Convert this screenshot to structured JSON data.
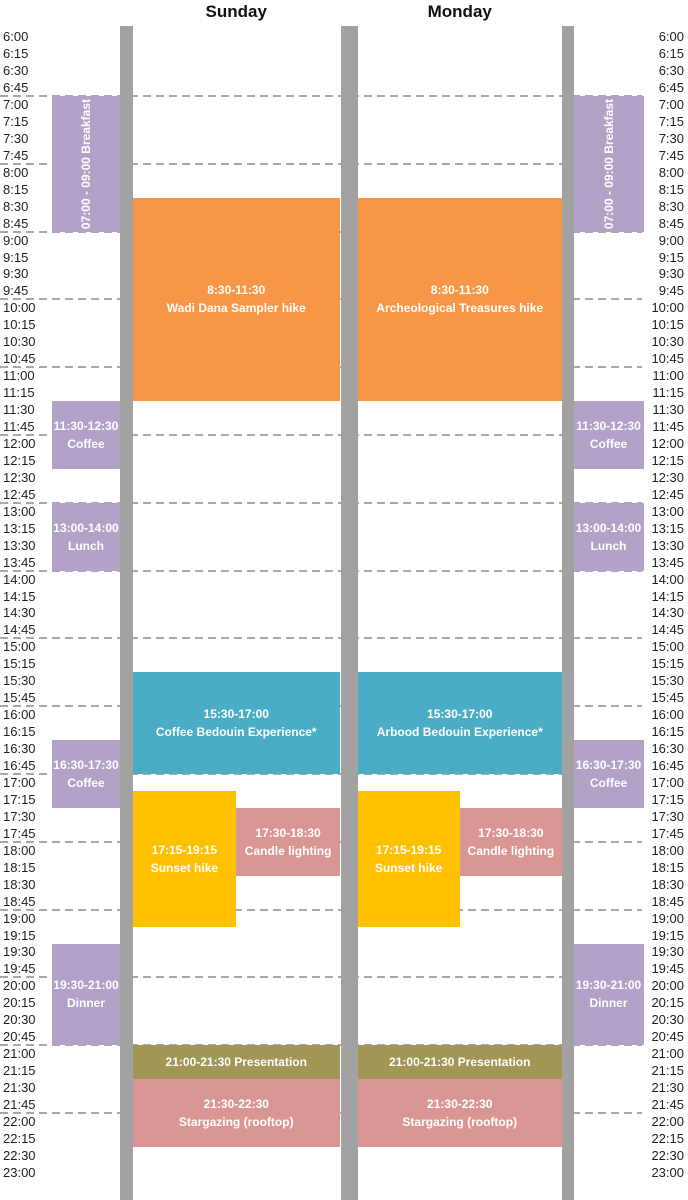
{
  "chart_data": {
    "type": "table",
    "title": "",
    "description_columns": [
      "Sunday",
      "Monday"
    ],
    "time_axis": {
      "start": "6:00",
      "end": "23:00",
      "step_minutes": 15,
      "labels": [
        "6:00",
        "6:15",
        "6:30",
        "6:45",
        "7:00",
        "7:15",
        "7:30",
        "7:45",
        "8:00",
        "8:15",
        "8:30",
        "8:45",
        "9:00",
        "9:15",
        "9:30",
        "9:45",
        "10:00",
        "10:15",
        "10:30",
        "10:45",
        "11:00",
        "11:15",
        "11:30",
        "11:45",
        "12:00",
        "12:15",
        "12:30",
        "12:45",
        "13:00",
        "13:15",
        "13:30",
        "13:45",
        "14:00",
        "14:15",
        "14:30",
        "14:45",
        "15:00",
        "15:15",
        "15:30",
        "15:45",
        "16:00",
        "16:15",
        "16:30",
        "16:45",
        "17:00",
        "17:15",
        "17:30",
        "17:45",
        "18:00",
        "18:15",
        "18:30",
        "18:45",
        "19:00",
        "19:15",
        "19:30",
        "19:45",
        "20:00",
        "20:15",
        "20:30",
        "20:45",
        "21:00",
        "21:15",
        "21:30",
        "21:45",
        "22:00",
        "22:15",
        "22:30",
        "23:00"
      ],
      "hour_gridlines": [
        "7:00",
        "8:00",
        "9:00",
        "10:00",
        "11:00",
        "12:00",
        "13:00",
        "14:00",
        "15:00",
        "16:00",
        "17:00",
        "18:00",
        "19:00",
        "20:00",
        "21:00",
        "22:00"
      ]
    },
    "days": [
      {
        "name": "Sunday",
        "events": [
          {
            "start": "8:30",
            "end": "11:30",
            "lines": [
              "8:30-11:30",
              "Wadi Dana Sampler hike"
            ],
            "color": "hike",
            "span": "full"
          },
          {
            "start": "15:30",
            "end": "17:00",
            "lines": [
              "15:30-17:00",
              "Coffee Bedouin Experience*"
            ],
            "color": "bedouin",
            "span": "full"
          },
          {
            "start": "17:15",
            "end": "19:15",
            "lines": [
              "17:15-19:15",
              "Sunset hike"
            ],
            "color": "sunset",
            "span": "left"
          },
          {
            "start": "17:30",
            "end": "18:30",
            "lines": [
              "17:30-18:30",
              "Candle lighting"
            ],
            "color": "rose",
            "span": "right"
          },
          {
            "start": "21:00",
            "end": "21:30",
            "lines": [
              "21:00-21:30 Presentation"
            ],
            "color": "presentation",
            "span": "full"
          },
          {
            "start": "21:30",
            "end": "22:30",
            "lines": [
              "21:30-22:30",
              "Stargazing (rooftop)"
            ],
            "color": "rose",
            "span": "full"
          }
        ]
      },
      {
        "name": "Monday",
        "events": [
          {
            "start": "8:30",
            "end": "11:30",
            "lines": [
              "8:30-11:30",
              "Archeological Treasures hike"
            ],
            "color": "hike",
            "span": "full"
          },
          {
            "start": "15:30",
            "end": "17:00",
            "lines": [
              "15:30-17:00",
              "Arbood Bedouin Experience*"
            ],
            "color": "bedouin",
            "span": "full"
          },
          {
            "start": "17:15",
            "end": "19:15",
            "lines": [
              "17:15-19:15",
              "Sunset hike"
            ],
            "color": "sunset",
            "span": "left"
          },
          {
            "start": "17:30",
            "end": "18:30",
            "lines": [
              "17:30-18:30",
              "Candle lighting"
            ],
            "color": "rose",
            "span": "right"
          },
          {
            "start": "21:00",
            "end": "21:30",
            "lines": [
              "21:00-21:30 Presentation"
            ],
            "color": "presentation",
            "span": "full"
          },
          {
            "start": "21:30",
            "end": "22:30",
            "lines": [
              "21:30-22:30",
              "Stargazing (rooftop)"
            ],
            "color": "rose",
            "span": "full"
          }
        ]
      }
    ],
    "meal_rail_events": [
      {
        "start": "7:00",
        "end": "9:00",
        "lines": [
          "07:00 - 09:00 Breakfast"
        ],
        "orientation": "vertical",
        "color": "meal",
        "name": "breakfast"
      },
      {
        "start": "11:30",
        "end": "12:30",
        "lines": [
          "11:30-12:30",
          "Coffee"
        ],
        "orientation": "horizontal",
        "color": "meal",
        "name": "coffee-morning"
      },
      {
        "start": "13:00",
        "end": "14:00",
        "lines": [
          "13:00-14:00",
          "Lunch"
        ],
        "orientation": "horizontal",
        "color": "meal",
        "name": "lunch"
      },
      {
        "start": "16:30",
        "end": "17:30",
        "lines": [
          "16:30-17:30",
          "Coffee"
        ],
        "orientation": "horizontal",
        "color": "meal",
        "name": "coffee-afternoon"
      },
      {
        "start": "19:30",
        "end": "21:00",
        "lines": [
          "19:30-21:00",
          "Dinner"
        ],
        "orientation": "horizontal",
        "color": "meal",
        "name": "dinner"
      }
    ]
  },
  "colors": {
    "hike": "#F79646",
    "bedouin": "#4BACC6",
    "sunset": "#FFC000",
    "rose": "#D99694",
    "presentation": "#A19655",
    "meal": "#B2A2C7",
    "separator_bar": "#A2A2A2",
    "gridline": "#A8A8A8",
    "axis_text": "#1F1F1F",
    "event_text": "#FFFFFF",
    "background": "#FFFFFF"
  }
}
